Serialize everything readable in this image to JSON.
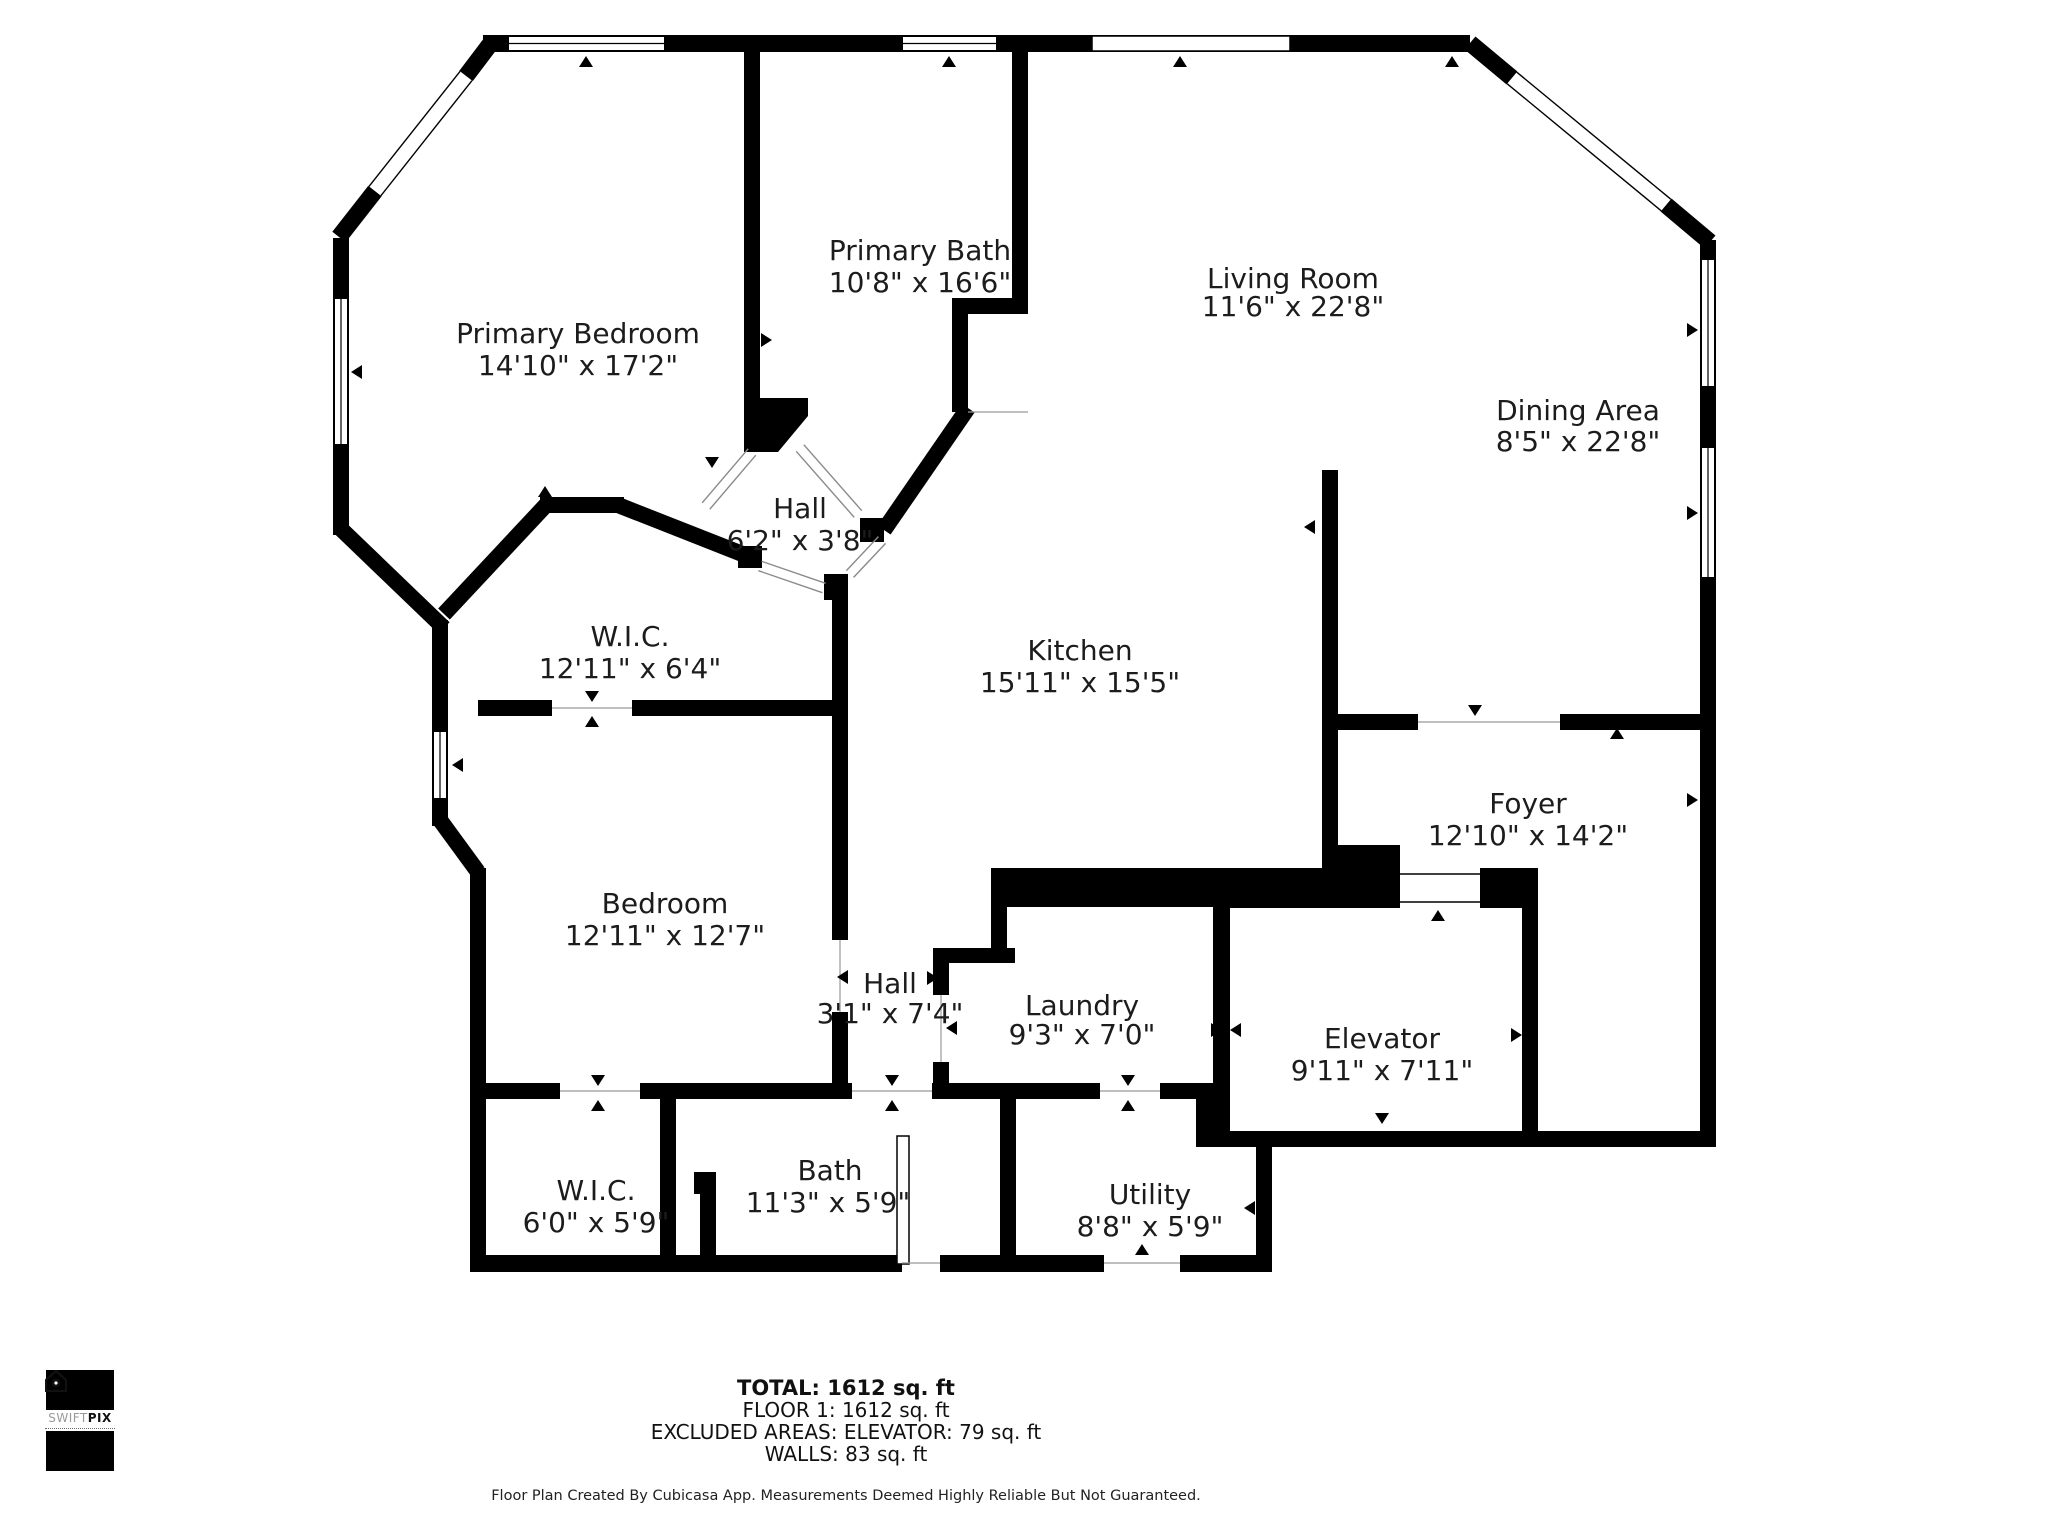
{
  "rooms": [
    {
      "id": "primary-bedroom",
      "name": "Primary Bedroom",
      "dims": "14'10\" x 17'2\""
    },
    {
      "id": "primary-bath",
      "name": "Primary Bath",
      "dims": "10'8\" x 16'6\""
    },
    {
      "id": "living-room",
      "name": "Living Room",
      "dims": "11'6\" x 22'8\""
    },
    {
      "id": "dining-area",
      "name": "Dining Area",
      "dims": "8'5\" x 22'8\""
    },
    {
      "id": "hall-upper",
      "name": "Hall",
      "dims": "6'2\" x 3'8\""
    },
    {
      "id": "wic-upper",
      "name": "W.I.C.",
      "dims": "12'11\" x 6'4\""
    },
    {
      "id": "kitchen",
      "name": "Kitchen",
      "dims": "15'11\" x 15'5\""
    },
    {
      "id": "foyer",
      "name": "Foyer",
      "dims": "12'10\" x 14'2\""
    },
    {
      "id": "bedroom",
      "name": "Bedroom",
      "dims": "12'11\" x 12'7\""
    },
    {
      "id": "hall-lower",
      "name": "Hall",
      "dims": "3'1\" x 7'4\""
    },
    {
      "id": "laundry",
      "name": "Laundry",
      "dims": "9'3\" x 7'0\""
    },
    {
      "id": "elevator",
      "name": "Elevator",
      "dims": "9'11\" x 7'11\""
    },
    {
      "id": "wic-lower",
      "name": "W.I.C.",
      "dims": "6'0\" x 5'9\""
    },
    {
      "id": "bath",
      "name": "Bath",
      "dims": "11'3\" x 5'9\""
    },
    {
      "id": "utility",
      "name": "Utility",
      "dims": "8'8\" x 5'9\""
    }
  ],
  "summary": {
    "total": "TOTAL: 1612 sq. ft",
    "floor": "FLOOR 1: 1612 sq. ft",
    "excluded": "EXCLUDED AREAS: ELEVATOR: 79 sq. ft",
    "walls": "WALLS: 83 sq. ft"
  },
  "disclaimer": "Floor Plan Created By Cubicasa App. Measurements Deemed Highly Reliable But Not Guaranteed.",
  "logo": {
    "brand_light": "SWIFT",
    "brand_bold": "PIX"
  },
  "colors": {
    "wall": "#000000",
    "text": "#1c1c1c",
    "door_line": "#8a8a8a"
  }
}
